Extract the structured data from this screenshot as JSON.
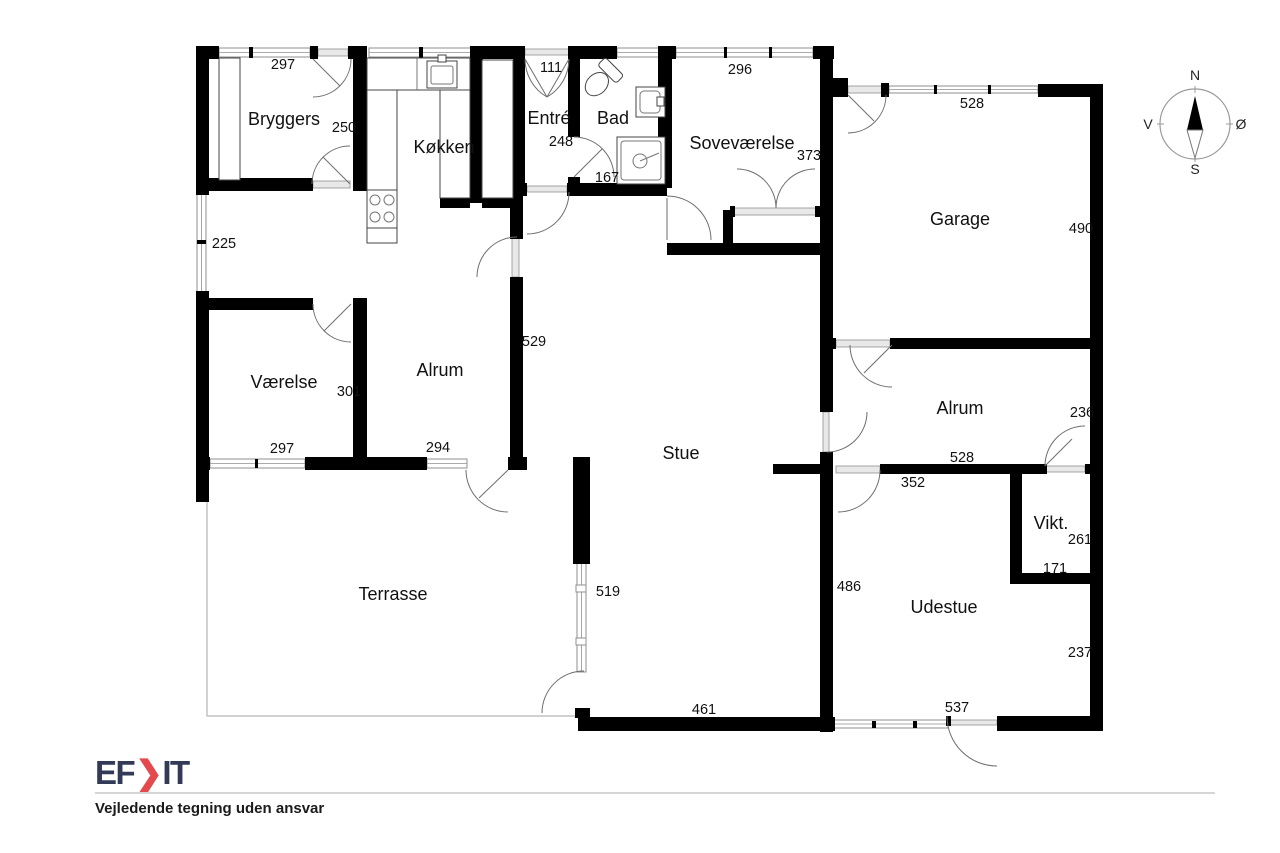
{
  "plan": {
    "rooms": [
      {
        "id": "bryggers",
        "label": "Bryggers"
      },
      {
        "id": "kokken",
        "label": "Køkken"
      },
      {
        "id": "entre",
        "label": "Entré"
      },
      {
        "id": "bad",
        "label": "Bad"
      },
      {
        "id": "sovevaerelse",
        "label": "Soveværelse"
      },
      {
        "id": "garage",
        "label": "Garage"
      },
      {
        "id": "vaerelse",
        "label": "Værelse"
      },
      {
        "id": "alrum-vest",
        "label": "Alrum"
      },
      {
        "id": "stue",
        "label": "Stue"
      },
      {
        "id": "alrum-oest",
        "label": "Alrum"
      },
      {
        "id": "viktualierum",
        "label": "Vikt."
      },
      {
        "id": "terrasse",
        "label": "Terrasse"
      },
      {
        "id": "udestue",
        "label": "Udestue"
      }
    ],
    "dims": [
      {
        "value": "297"
      },
      {
        "value": "250"
      },
      {
        "value": "111"
      },
      {
        "value": "248"
      },
      {
        "value": "296"
      },
      {
        "value": "167"
      },
      {
        "value": "373"
      },
      {
        "value": "528"
      },
      {
        "value": "490"
      },
      {
        "value": "225"
      },
      {
        "value": "529"
      },
      {
        "value": "301"
      },
      {
        "value": "297"
      },
      {
        "value": "294"
      },
      {
        "value": "236"
      },
      {
        "value": "528"
      },
      {
        "value": "352"
      },
      {
        "value": "261"
      },
      {
        "value": "171"
      },
      {
        "value": "486"
      },
      {
        "value": "519"
      },
      {
        "value": "461"
      },
      {
        "value": "237"
      },
      {
        "value": "537"
      }
    ]
  },
  "compass": {
    "north": "N",
    "south": "S",
    "west": "V",
    "east": "Ø"
  },
  "footer": {
    "logo_prefix": "EF",
    "logo_chevron": "❯",
    "logo_suffix": "IT",
    "disclaimer": "Vejledende tegning uden ansvar"
  },
  "colors": {
    "wall": "#000000",
    "window_stroke": "#8f8f8f",
    "door_arc": "#6e6e6e",
    "brand_navy": "#333a57",
    "brand_red": "#e4494e",
    "text": "#111111"
  }
}
